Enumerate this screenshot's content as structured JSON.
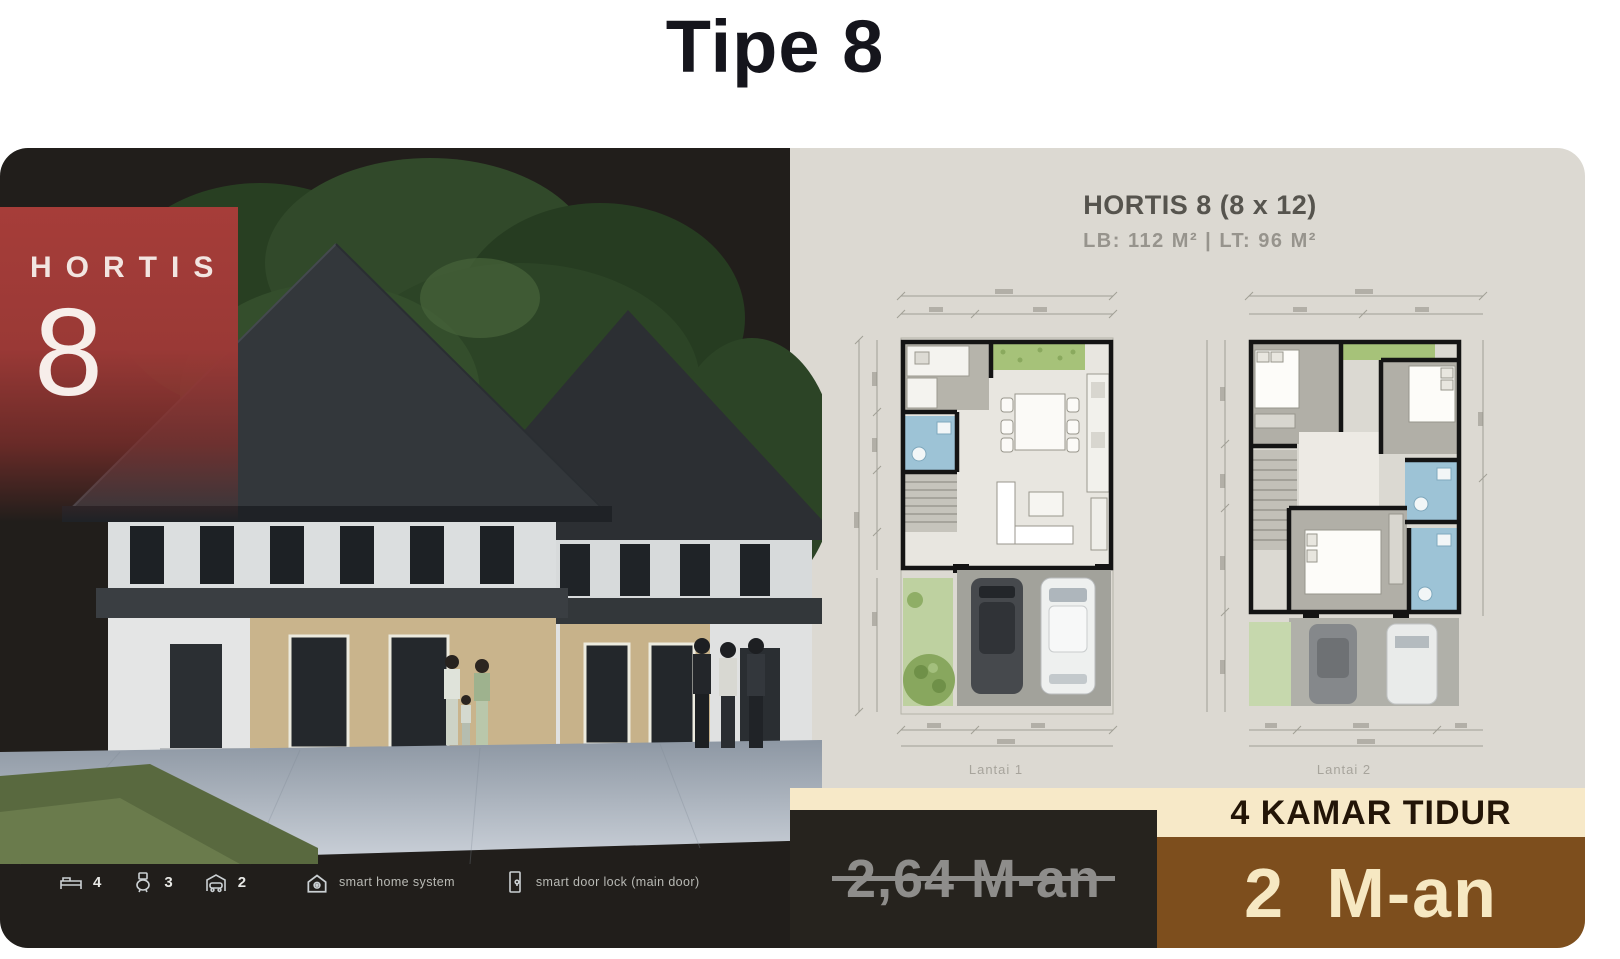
{
  "page": {
    "title": "Tipe 8"
  },
  "left_panel": {
    "badge": {
      "brand": "HORTIS",
      "number": "8"
    },
    "features": {
      "bedrooms": "4",
      "bathrooms": "3",
      "garage": "2",
      "smart_home": "smart home system",
      "smart_door": "smart door lock (main door)"
    }
  },
  "right_panel": {
    "header": {
      "title": "HORTIS 8 (8 x 12)",
      "subtitle": "LB: 112 M²   |   LT: 96 M²"
    },
    "plans": [
      {
        "label": "Lantai 1"
      },
      {
        "label": "Lantai 2"
      }
    ],
    "bedrooms_banner": "4 KAMAR TIDUR",
    "price_old": "2,64 M-an",
    "price_new": "2 M-an"
  },
  "colors": {
    "panel_dark": "#211e1b",
    "panel_light": "#dcd9d2",
    "badge_red": "#a63d39",
    "cream_band": "#f7e9c8",
    "brown_block": "#7d4e1d",
    "price_old_text": "#8e8d8b",
    "price_new_text": "#f6e8c2"
  }
}
